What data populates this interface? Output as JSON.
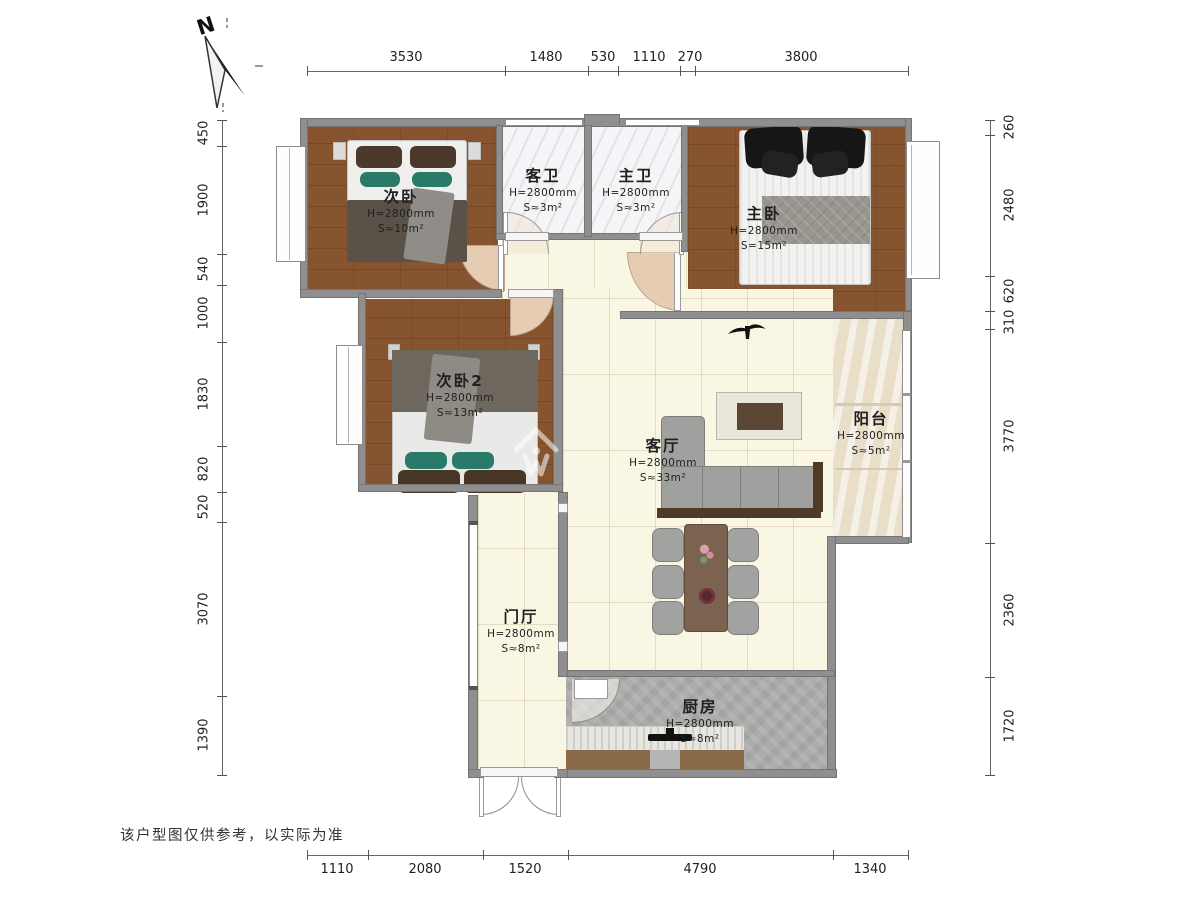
{
  "compass": {
    "label": "N"
  },
  "disclaimer": "该户型图仅供参考，以实际为准",
  "dims_top": [
    "3530",
    "1480",
    "530",
    "1110",
    "270",
    "3800"
  ],
  "dims_bottom": [
    "1110",
    "2080",
    "1520",
    "4790",
    "1340"
  ],
  "dims_left": [
    "450",
    "1900",
    "540",
    "1000",
    "1830",
    "820",
    "520",
    "3070",
    "1390"
  ],
  "dims_right": [
    "260",
    "2480",
    "620",
    "310",
    "3770",
    "2360",
    "1720"
  ],
  "rooms": {
    "second_bedroom": {
      "name": "次卧",
      "height": "H=2800mm",
      "area": "S≈10m²"
    },
    "guest_bath": {
      "name": "客卫",
      "height": "H=2800mm",
      "area": "S≈3m²"
    },
    "master_bath": {
      "name": "主卫",
      "height": "H=2800mm",
      "area": "S≈3m²"
    },
    "master_bedroom": {
      "name": "主卧",
      "height": "H=2800mm",
      "area": "S=15m²"
    },
    "second_bedroom2": {
      "name": "次卧2",
      "height": "H=2800mm",
      "area": "S≈13m²"
    },
    "living_room": {
      "name": "客厅",
      "height": "H=2800mm",
      "area": "S≈33m²"
    },
    "balcony": {
      "name": "阳台",
      "height": "H=2800mm",
      "area": "S≈5m²"
    },
    "entry_hall": {
      "name": "门厅",
      "height": "H=2800mm",
      "area": "S≈8m²"
    },
    "kitchen": {
      "name": "厨房",
      "height": "H=2800mm",
      "area": "S≈8m²"
    }
  },
  "colors": {
    "wood": "#8a5732",
    "tile_cream": "#faf6e4",
    "bath_white": "#f5f5f7",
    "balcony": "#e9dfc9",
    "kitchen_gray": "#acacaa",
    "wall": "#8f8f8f",
    "door_arc": "#e6ccb2",
    "accent_teal": "#2a7a6a"
  }
}
